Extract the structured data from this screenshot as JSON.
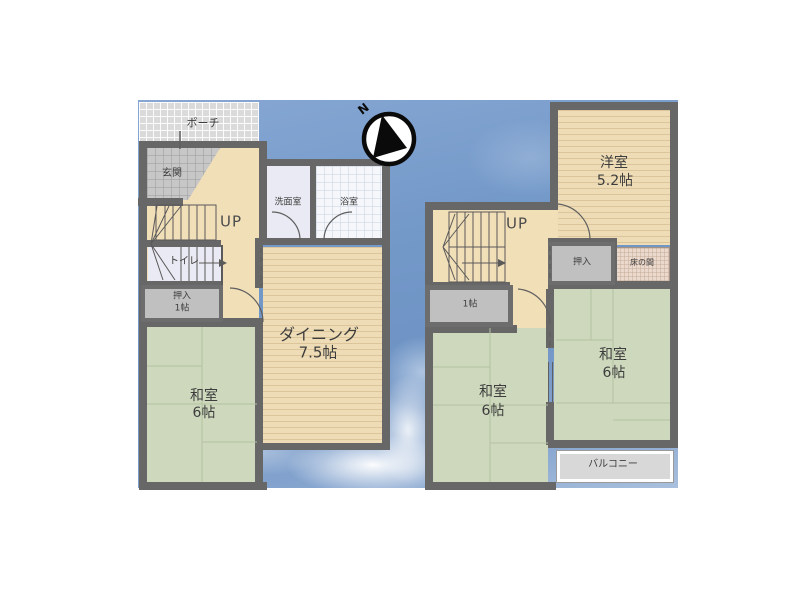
{
  "floorplan": {
    "title": "2-story Japanese house floor plan",
    "compass_label": "N",
    "colors": {
      "wall": "#676767",
      "sky_blue": "#6e93c4",
      "wood_beige": "#eedcb6",
      "tatami_green": "#cdd8bd",
      "closet_gray": "#c0c0c0"
    },
    "floor1": {
      "porch": "ポーチ",
      "entrance": "玄関",
      "stairs": "UP",
      "washroom": "洗面室",
      "bathroom": "浴室",
      "toilet": "トイレ",
      "closet_line1": "押入",
      "closet_line2": "1帖",
      "dining_line1": "ダイニング",
      "dining_line2": "7.5帖",
      "washitsu_line1": "和室",
      "washitsu_line2": "6帖"
    },
    "floor2": {
      "stairs": "UP",
      "yoshitsu_line1": "洋室",
      "yoshitsu_line2": "5.2帖",
      "closet": "押入",
      "tokonoma": "床の間",
      "storage": "1帖",
      "washitsu_left_line1": "和室",
      "washitsu_left_line2": "6帖",
      "washitsu_right_line1": "和室",
      "washitsu_right_line2": "6帖",
      "balcony": "バルコニー"
    }
  }
}
